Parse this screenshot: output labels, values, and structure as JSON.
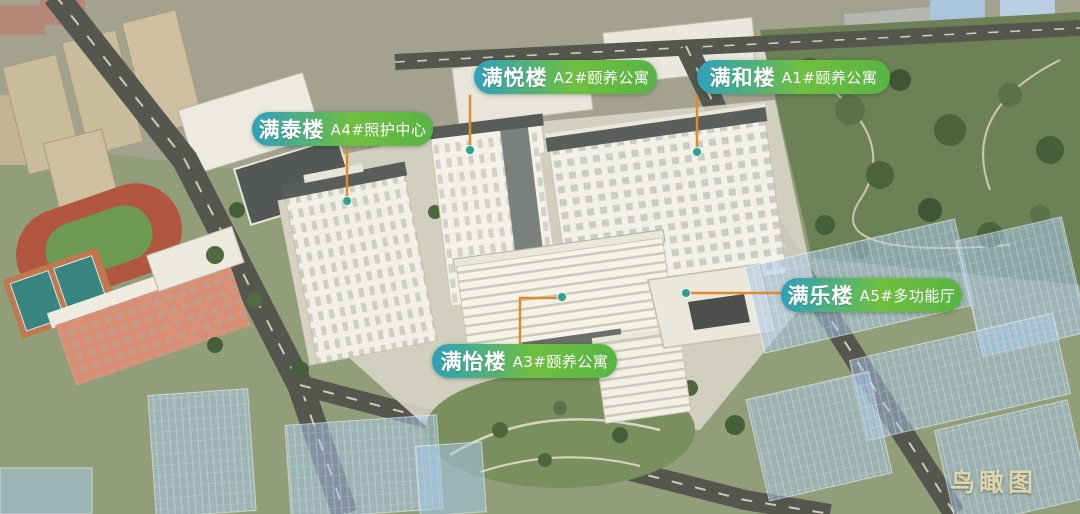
{
  "scene": {
    "type": "aerial-bird's-eye-rendering",
    "watermark": "鸟瞰图"
  },
  "labels": [
    {
      "id": "A4",
      "name": "满泰楼",
      "unit": "A4#照护中心"
    },
    {
      "id": "A2",
      "name": "满悦楼",
      "unit": "A2#颐养公寓"
    },
    {
      "id": "A1",
      "name": "满和楼",
      "unit": "A1#颐养公寓"
    },
    {
      "id": "A5",
      "name": "满乐楼",
      "unit": "A5#多功能厅"
    },
    {
      "id": "A3",
      "name": "满怡楼",
      "unit": "A3#颐养公寓"
    }
  ],
  "colors": {
    "label_gradient_start": "#2fa0bd",
    "label_gradient_end": "#57b445",
    "leader_line": "#e08a2f",
    "leader_dot": "#2fa08c",
    "watermark_text": "#ded6ae"
  }
}
